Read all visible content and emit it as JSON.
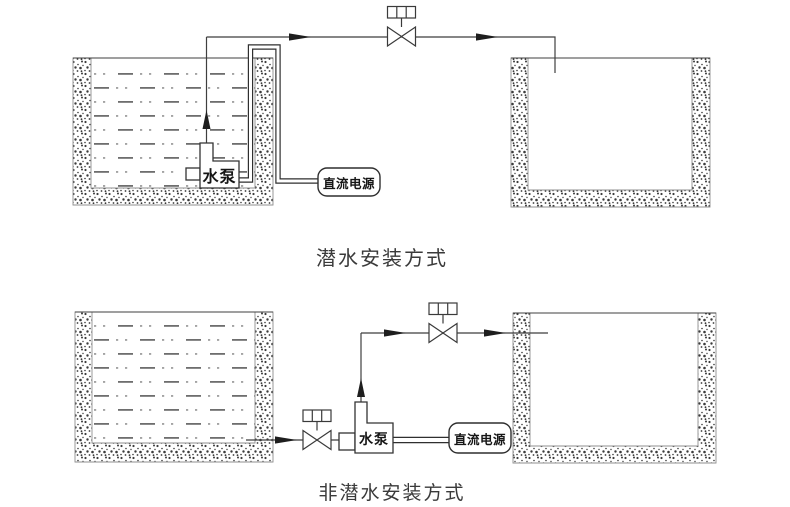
{
  "page": {
    "background": "#ffffff"
  },
  "colors": {
    "pipe_line": "#3f3f3f",
    "water_dash": "#6e6e6e",
    "wall_stipple": "#3b3b3b",
    "arrow": "#1e1e1e",
    "label_text": "#161616",
    "caption_text": "#3a3a3a"
  },
  "top_diagram": {
    "caption": "潜水安装方式",
    "pump_label": "水泵",
    "power_label": "直流电源"
  },
  "bottom_diagram": {
    "caption": "非潜水安装方式",
    "pump_label": "水泵",
    "power_label": "直流电源"
  }
}
